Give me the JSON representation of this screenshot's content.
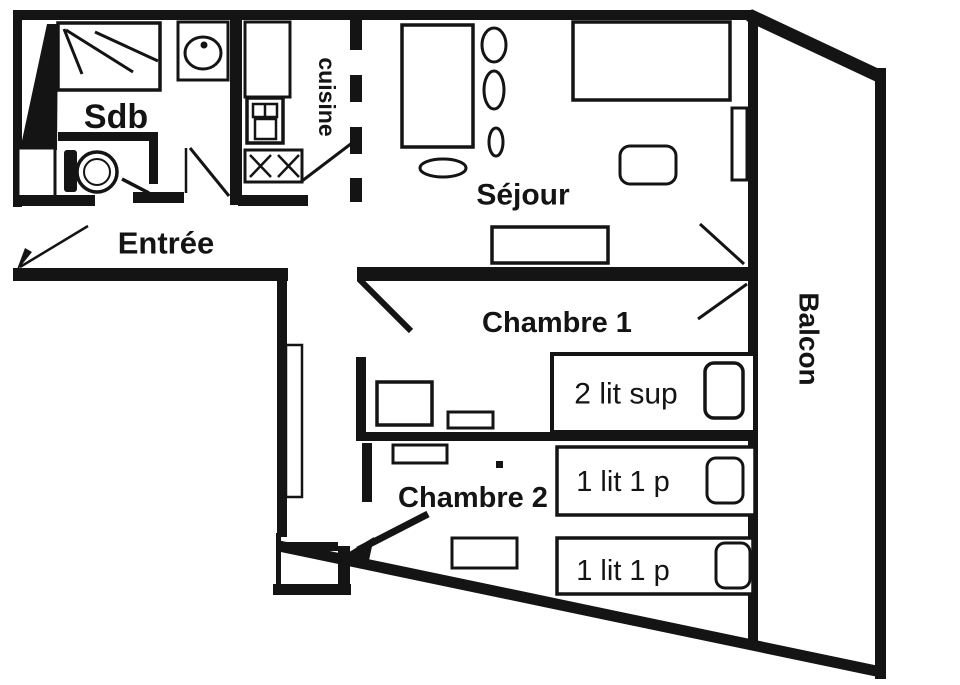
{
  "plan": {
    "colors": {
      "ink": "#141414",
      "background": "#ffffff"
    },
    "rooms": {
      "sdb": {
        "label": "Sdb"
      },
      "entree": {
        "label": "Entrée"
      },
      "cuisine": {
        "label": "cuisine"
      },
      "sejour": {
        "label": "Séjour"
      },
      "chambre1": {
        "label": "Chambre 1"
      },
      "chambre2": {
        "label": "Chambre 2"
      },
      "balcon": {
        "label": "Balcon"
      }
    },
    "beds": {
      "chambre1_bunk": {
        "label": "2 lit sup"
      },
      "chambre2_upper": {
        "label": "1 lit 1 p"
      },
      "chambre2_lower": {
        "label": "1 lit 1 p"
      }
    }
  }
}
